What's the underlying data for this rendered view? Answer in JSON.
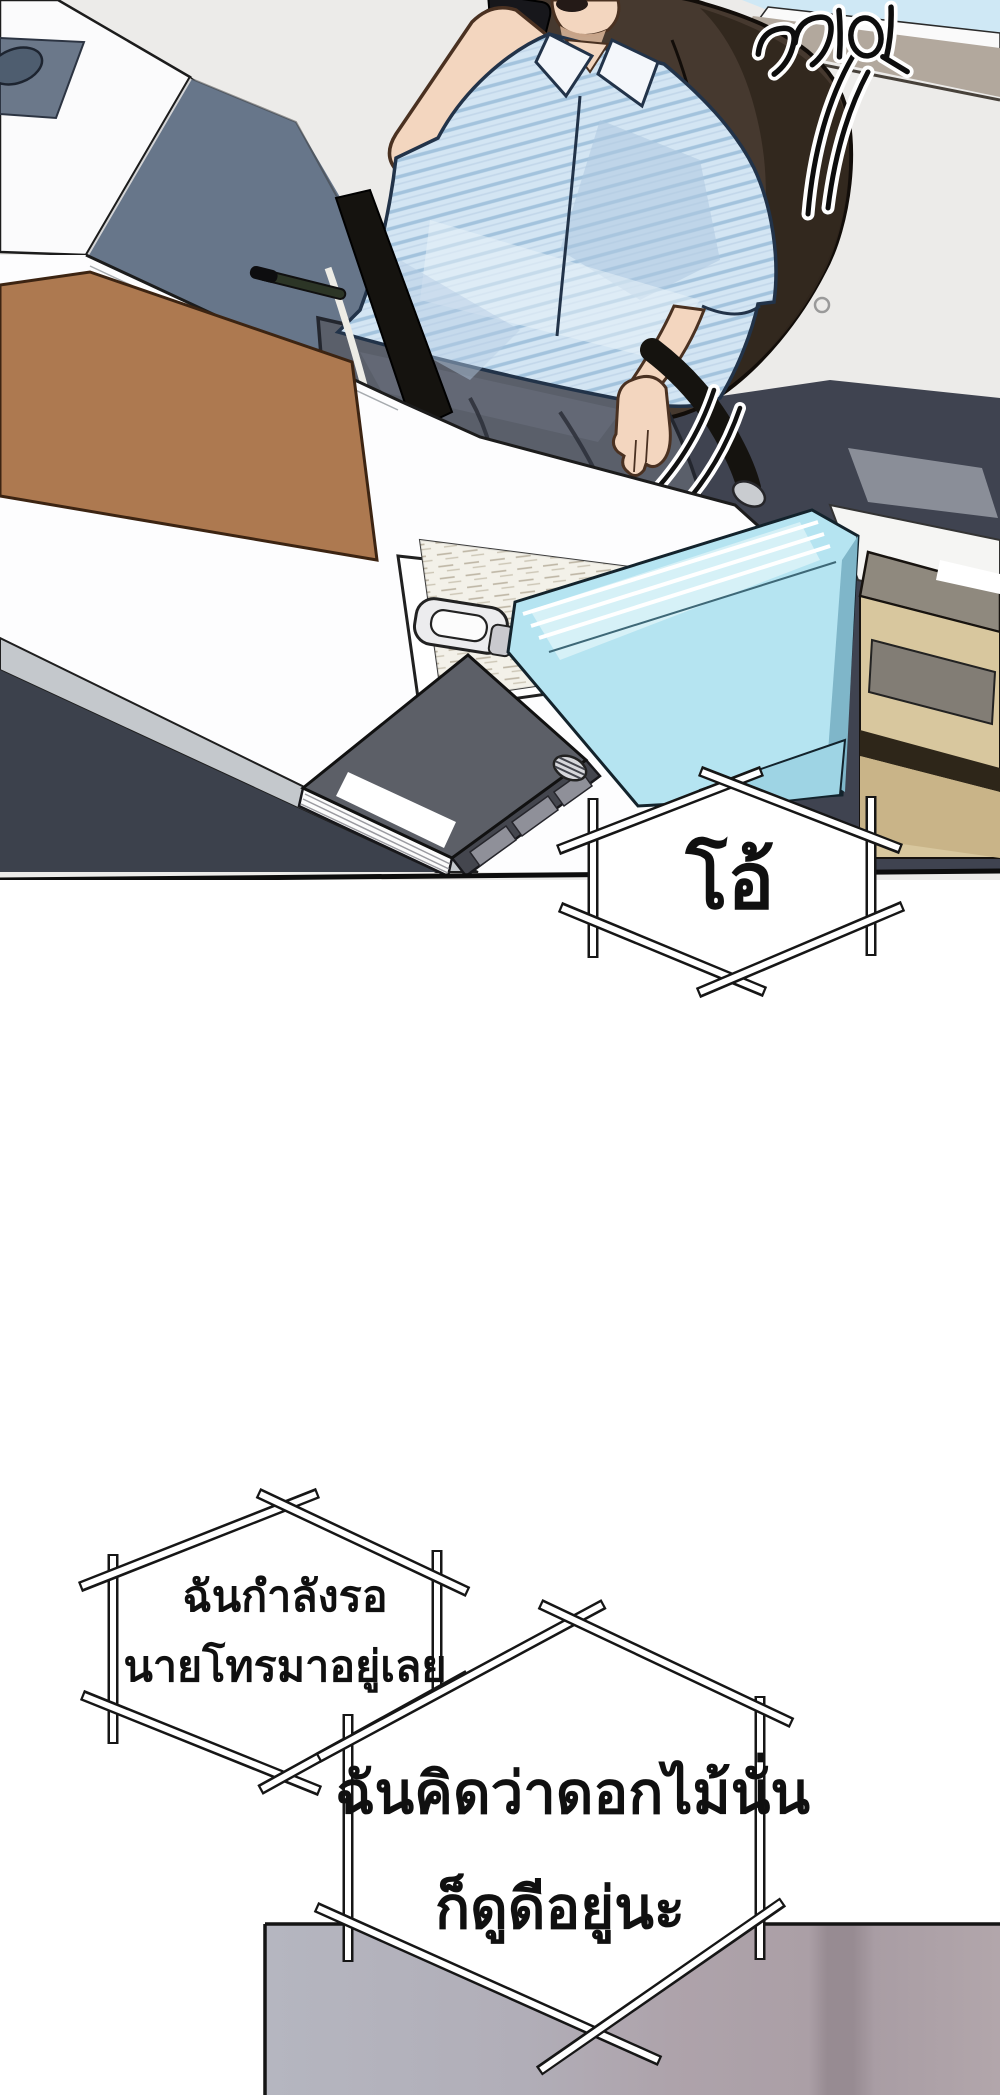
{
  "page": {
    "type": "webtoon_comic_panel",
    "language": "th",
    "width_px": 1000,
    "height_px": 2095,
    "description": "Office scene: man in striped shirt on phone at desk, followed by speech bubbles"
  },
  "sfx": {
    "text": "끼익",
    "meaning": "creak"
  },
  "bubbles": {
    "oh": {
      "lines": [
        "โอ้"
      ]
    },
    "waiting": {
      "lines": [
        "ฉันกำลังรอ",
        "นายโทรมาอยู่เลย"
      ]
    },
    "flowers": {
      "lines": [
        "ฉันคิดว่าดอกไม้นั่น",
        "ก็ดูดีอยู่นะ"
      ]
    }
  },
  "colors": {
    "sky_blue": "#cfe8f5",
    "window_sill_tan": "#b2a89d",
    "wall_light": "#ecebe9",
    "floor_slate": "#67768a",
    "floor_charcoal": "#3f4350",
    "chair_brown": "#46392f",
    "shirt_blue": "#d3e5f3",
    "shirt_stripe": "#a3c3dd",
    "pants_gray": "#5a5f6a",
    "desk_pad_brown": "#ad7950",
    "folder_cyan": "#b5e4f1",
    "binder_gray": "#5c5f67",
    "cabinet_tan": "#d8c79e",
    "bottom_wall_mauve": "#ab9fa6",
    "bottom_wall_gray": "#b5b6c0"
  }
}
